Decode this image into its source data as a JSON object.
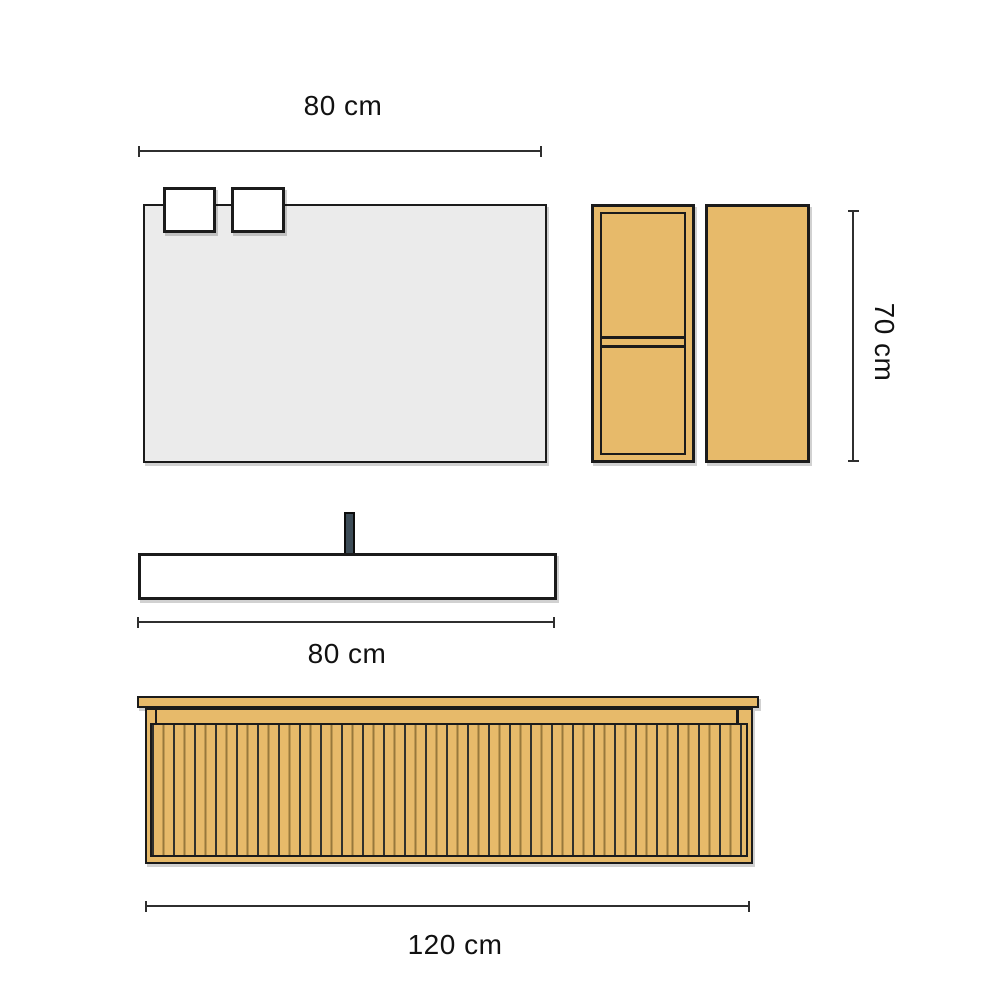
{
  "diagram": {
    "type": "furniture-dimension-drawing",
    "subject": "bathroom vanity set: mirror with lights, two wall cabinets, washbasin with faucet, fluted vanity unit"
  },
  "colors": {
    "canvas-bg": "#ffffff",
    "wood": "#e7ba6a",
    "mirror-glass": "#ebebeb",
    "basin-white": "#ffffff",
    "faucet-steel": "#3d4c57",
    "outline": "#1b1b1b",
    "dim-line": "#2f2f2f",
    "groove-dark": "#32322e",
    "groove-light": "#97783c"
  },
  "dimensions": [
    {
      "id": "mirror-width",
      "label": "80 cm",
      "orientation": "horizontal",
      "refers_to": "mirror"
    },
    {
      "id": "cabinet-height",
      "label": "70 cm",
      "orientation": "vertical",
      "refers_to": "wall-cabinets"
    },
    {
      "id": "basin-width",
      "label": "80 cm",
      "orientation": "horizontal",
      "refers_to": "washbasin"
    },
    {
      "id": "vanity-width",
      "label": "120 cm",
      "orientation": "horizontal",
      "refers_to": "vanity-unit"
    }
  ]
}
